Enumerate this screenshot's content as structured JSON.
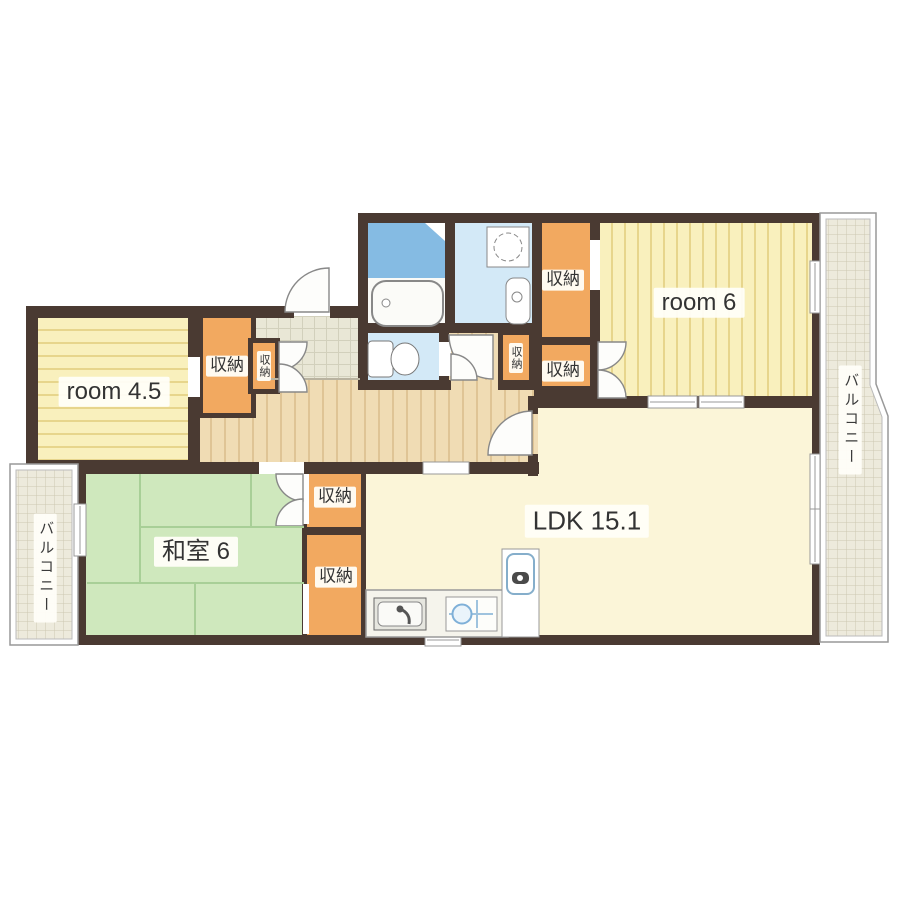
{
  "title": "apartment-floor-plan",
  "rooms": {
    "room45": {
      "label": "room 4.5"
    },
    "room6": {
      "label": "room 6"
    },
    "ldk": {
      "label": "LDK 15.1"
    },
    "washitsu": {
      "label": "和室 6"
    }
  },
  "storage": {
    "label": "収納"
  },
  "balcony": {
    "label": "バルコニー"
  },
  "fixtures": [
    "bathtub",
    "shower-room",
    "washing-machine",
    "washbasin",
    "toilet",
    "kitchen-sink",
    "stove",
    "refrigerator",
    "entry-door",
    "closet-doors"
  ],
  "colors": {
    "wall": "#4a3a32",
    "storage_orange": "#f2a960",
    "tatami_green": "#cfe8bd",
    "flooring_wood": "#f0dcb4",
    "room_stripe_yellow": "#f9f0bd",
    "ldk_cream": "#fbf5d8",
    "bath_blue": "#85bbe3",
    "washroom_blue": "#d3e9f7",
    "genkan_tile": "#e9e7d6",
    "balcony_tile": "#edeadc"
  }
}
